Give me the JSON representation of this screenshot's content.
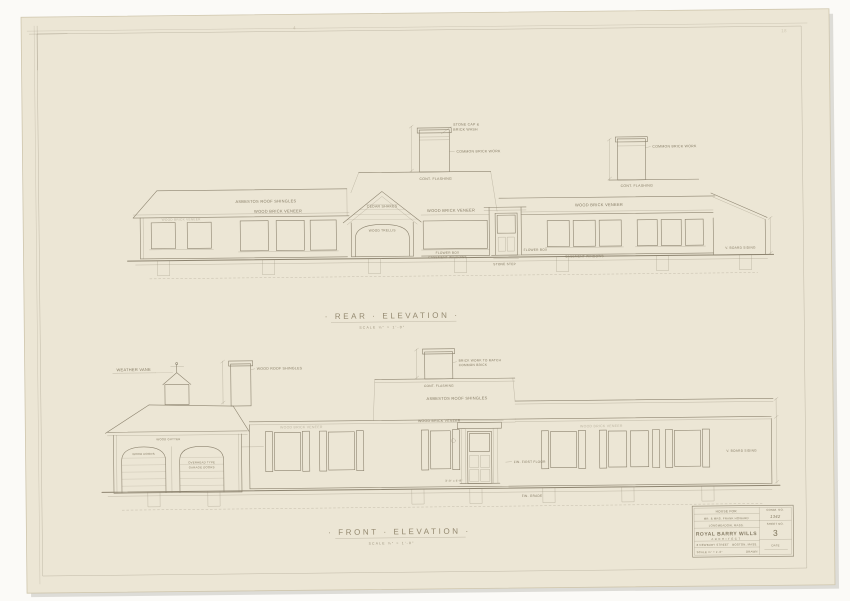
{
  "photo": {
    "background": "#fbfaf7",
    "paper_color": "#ece6d5",
    "ink_color": "#8d8470"
  },
  "pencil_marks": {
    "top_center": "4",
    "top_right": "18"
  },
  "rear_elevation": {
    "title": "· REAR · ELEVATION ·",
    "scale": "SCALE  ¼\" = 1'-0\"",
    "labels": {
      "roof_shingles": "ASBESTOS ROOF SHINGLES",
      "brick_veneer_left": "WOOD BRICK VENEER",
      "shakes": "CEDAR SHAKES",
      "trellis": "WOOD TRELLIS",
      "brick_veneer_center": "WOOD BRICK VENEER",
      "flower_box": "FLOWER BOX",
      "casement_center": "CASEMENT WINDOWS",
      "brick_veneer_right": "WOOD BRICK VENEER",
      "flower_box_right": "FLOWER BOX",
      "casement_right": "CASEMENT WINDOWS",
      "board_siding": "V. BOARD SIDING",
      "stone_step": "STONE STEP",
      "chimney1_cap1": "STONE CAP &",
      "chimney1_cap2": "BRICK WASH",
      "chimney1_brick": "COMMON BRICK WORK",
      "chimney1_flashing": "CONT. FLASHING",
      "chimney2_brick": "COMMON BRICK WORK",
      "chimney2_flashing": "CONT. FLASHING"
    }
  },
  "front_elevation": {
    "title": "· FRONT · ELEVATION ·",
    "scale": "SCALE  ¼\" = 1'-0\"",
    "labels": {
      "weather_vane": "WEATHER VANE",
      "roof_shingles_garage": "WOOD ROOF SHINGLES",
      "gutter": "WOOD GUTTER",
      "garage_door_left": "WOOD DOORS",
      "garage_door_right1": "OVERHEAD TYPE",
      "garage_door_right2": "GARAGE DOORS",
      "chimney_brick1": "BRICK WORK TO MATCH",
      "chimney_brick2": "COMMON BRICK",
      "chimney_flashing": "CONT. FLASHING",
      "roof_shingles_main": "ASBESTOS ROOF SHINGLES",
      "brick_veneer_left": "WOOD BRICK VENEER",
      "brick_veneer_door": "WOOD BRICK VENEER",
      "brick_veneer_right": "WOOD BRICK VENEER",
      "fin_floor": "FIN. FIRST FLOOR",
      "door_size": "3'-0\" x 6'-8\"",
      "board_siding": "V. BOARD SIDING",
      "grade": "FIN. GRADE"
    }
  },
  "title_block": {
    "project_line1": "HOUSE FOR",
    "project_line2": "MR. & MRS. FRANK HOWARD",
    "project_line3": "LONGMEADOW, MASS.",
    "architect_name": "ROYAL BARRY WILLS",
    "architect_title": "ARCHITECT",
    "address_left": "8 NEWBURY STREET",
    "address_right": "BOSTON, MASS.",
    "scale_note": "SCALE ¼\" = 1'-0\"",
    "drawn_label": "DRAWN",
    "comm_label": "COMM. NO.",
    "comm_no": "1342",
    "sheet_label": "SHEET NO.",
    "sheet_no": "3",
    "date_label": "DATE"
  }
}
